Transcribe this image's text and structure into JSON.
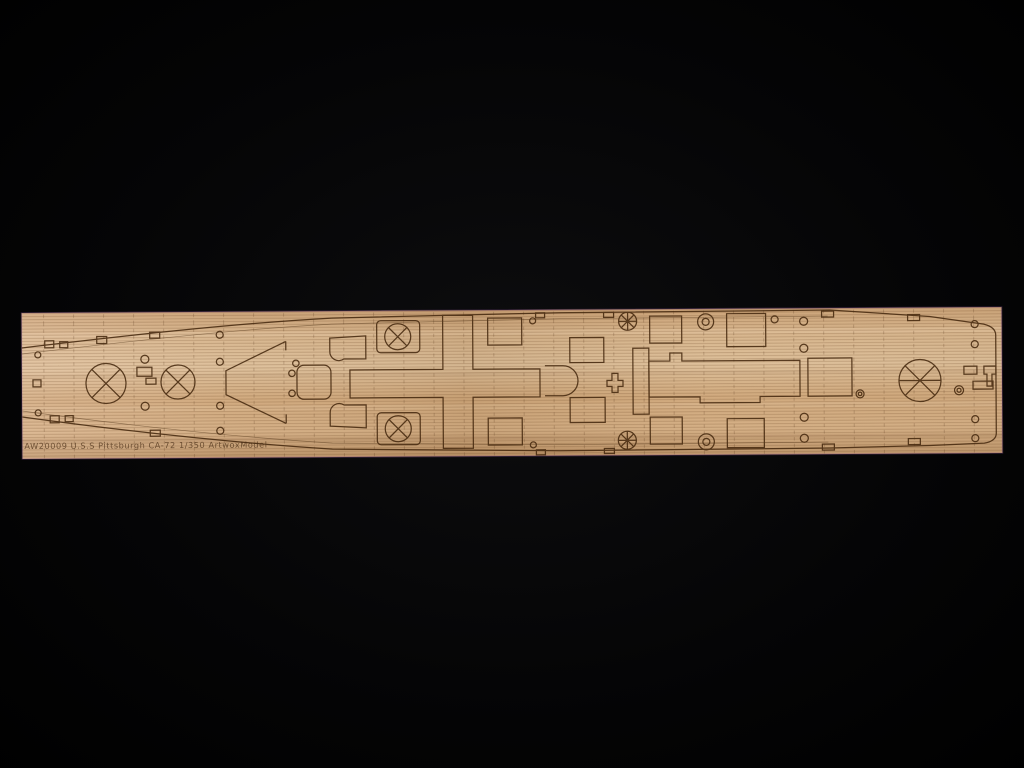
{
  "scene": {
    "type": "photograph",
    "subject": "laser-engraved wooden model warship deck sheet on black velvet background",
    "background_color": "#000000",
    "wood_light_color": "#dcbd97",
    "wood_mid_color": "#cda87d",
    "wood_dark_color": "#bd966a",
    "engraving_color": "#46290f"
  },
  "deck": {
    "etched_label": "AW20009 U.S.S Pittsburgh CA-72 1/350 ArtwoxModel"
  }
}
